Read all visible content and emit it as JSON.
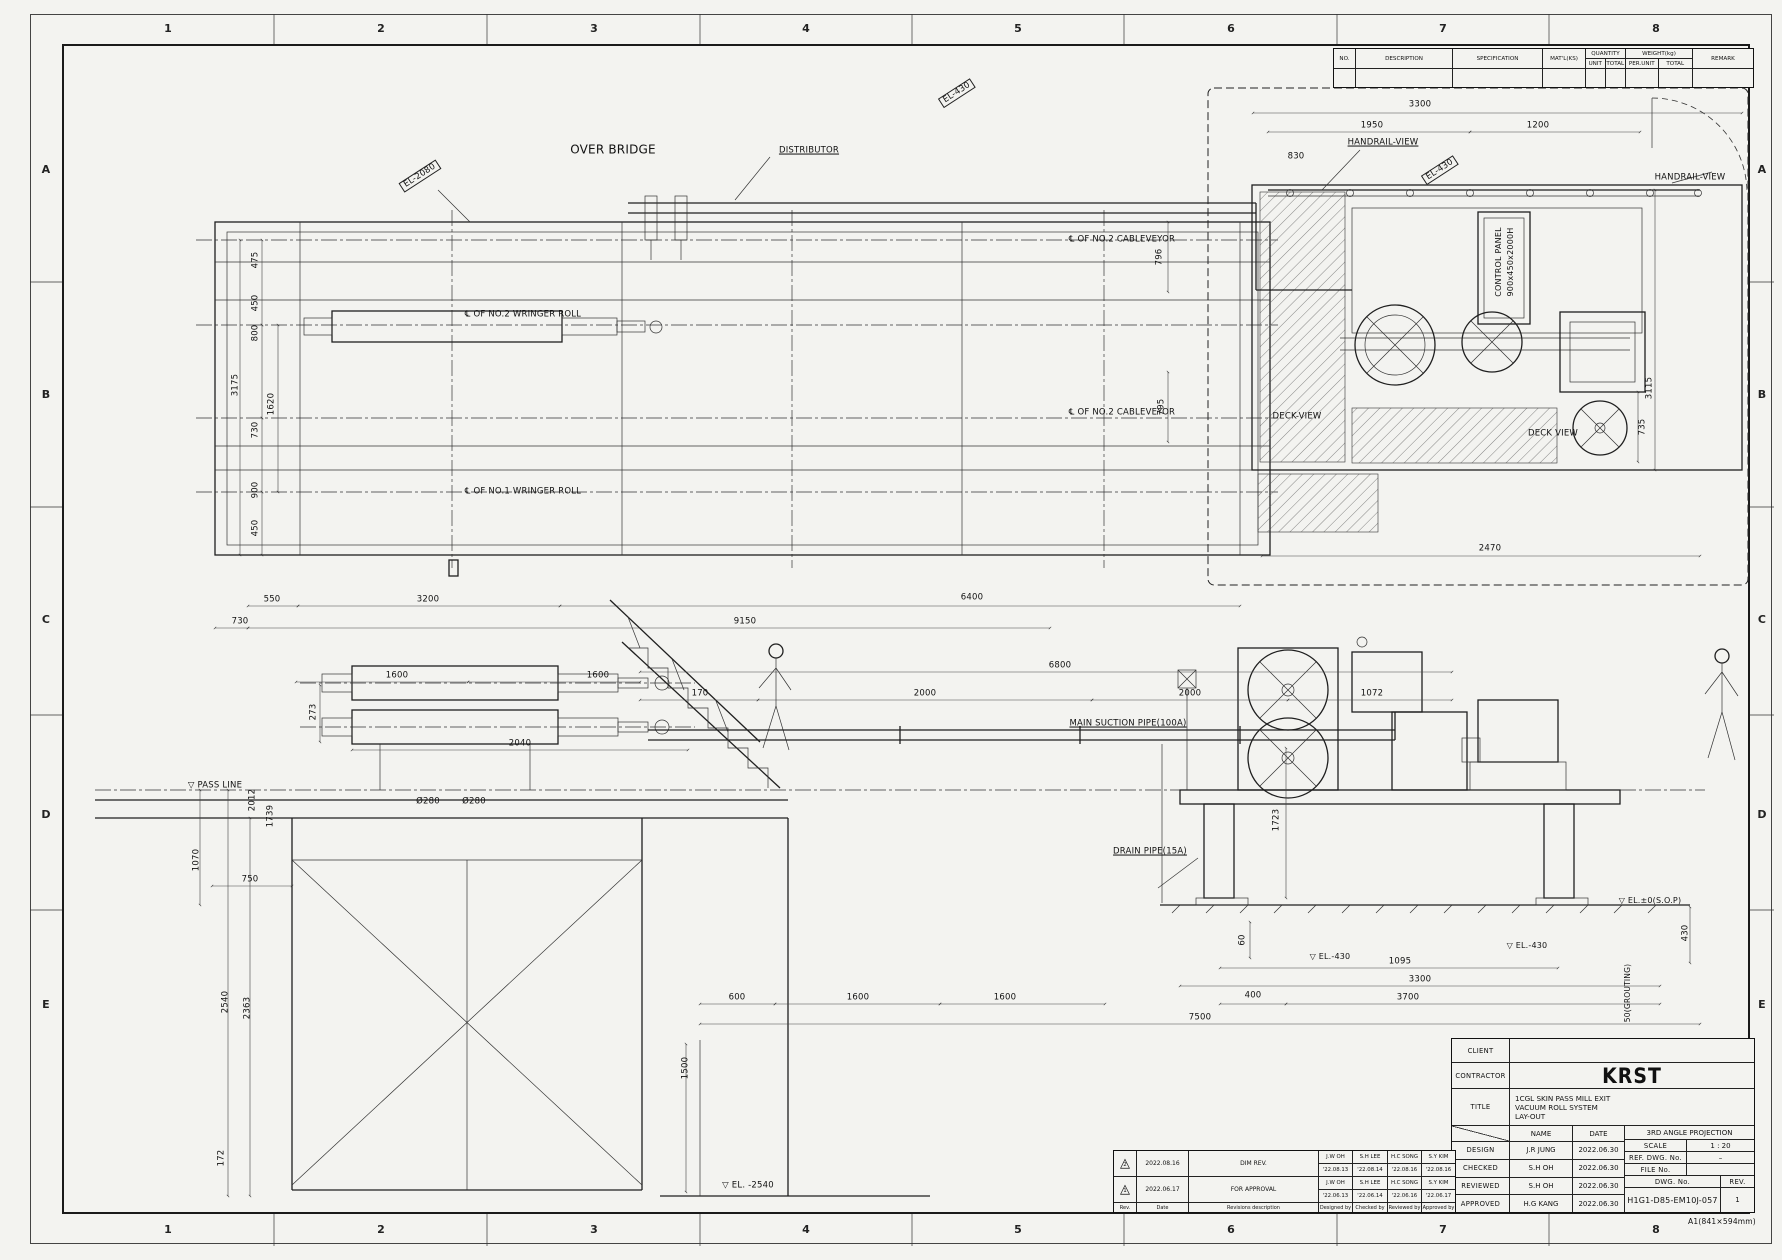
{
  "sheet": {
    "size_note": "A1(841×594mm)",
    "paper_color": "#f3f3f0",
    "line_color": "#1f1f1f"
  },
  "parts_table": {
    "no_label": "NO.",
    "description_label": "DESCRIPTION",
    "specification_label": "SPECIFICATION",
    "matl_label": "MAT'L(KS)",
    "quantity_label": "QUANTITY",
    "unit_label": "UNIT",
    "total_label": "TOTAL",
    "weight_label": "WEIGHT(kg)",
    "per_unit_label": "PER.UNIT",
    "remark_label": "REMARK"
  },
  "title_block": {
    "client_label": "CLIENT",
    "contractor_label": "CONTRACTOR",
    "contractor_name": "KRST",
    "title_label": "TITLE",
    "title_lines": [
      "1CGL SKIN PASS MILL EXIT",
      "VACUUM ROLL SYSTEM",
      "LAY-OUT"
    ],
    "name_label": "NAME",
    "date_label": "DATE",
    "rows": [
      {
        "label": "DESIGN",
        "name": "J.R JUNG",
        "date": "2022.06.30"
      },
      {
        "label": "CHECKED",
        "name": "S.H OH",
        "date": "2022.06.30"
      },
      {
        "label": "REVIEWED",
        "name": "S.H OH",
        "date": "2022.06.30"
      },
      {
        "label": "APPROVED",
        "name": "H.G KANG",
        "date": "2022.06.30"
      }
    ],
    "projection": "3RD ANGLE PROJECTION",
    "scale_label": "SCALE",
    "scale": "1 : 20",
    "ref_label": "REF. DWG. No.",
    "ref": "–",
    "file_label": "FILE No.",
    "file": "",
    "dwg_label": "DWG. No.",
    "dwg_no": "H1G1-D85-EM10J-057",
    "rev_label": "REV.",
    "rev": "1"
  },
  "revision_table": {
    "rows": [
      {
        "sym": "2",
        "date": "2022.08.16",
        "desc": "DIM REV.",
        "d_name": "J.W OH",
        "d_date": "'22.08.13",
        "c_name": "S.H LEE",
        "c_date": "'22.08.14",
        "r_name": "H.C SONG",
        "r_date": "'22.08.16",
        "a_name": "S.Y KIM",
        "a_date": "'22.08.16"
      },
      {
        "sym": "1",
        "date": "2022.06.17",
        "desc": "FOR APPROVAL",
        "d_name": "J.W OH",
        "d_date": "'22.06.13",
        "c_name": "S.H LEE",
        "c_date": "'22.06.14",
        "r_name": "H.C SONG",
        "r_date": "'22.06.16",
        "a_name": "S.Y KIM",
        "a_date": "'22.06.17"
      }
    ],
    "footer": [
      "Rev.",
      "Date",
      "Revisions description",
      "Designed by",
      "Checked by",
      "Reviewed by",
      "Approved by"
    ]
  },
  "annotations": [
    {
      "t": "1",
      "x": 168,
      "y": 29,
      "c": "grid",
      "n": "grid-col-1-top"
    },
    {
      "t": "2",
      "x": 381,
      "y": 29,
      "c": "grid",
      "n": "grid-col-2-top"
    },
    {
      "t": "3",
      "x": 594,
      "y": 29,
      "c": "grid",
      "n": "grid-col-3-top"
    },
    {
      "t": "4",
      "x": 806,
      "y": 29,
      "c": "grid",
      "n": "grid-col-4-top"
    },
    {
      "t": "5",
      "x": 1018,
      "y": 29,
      "c": "grid",
      "n": "grid-col-5-top"
    },
    {
      "t": "6",
      "x": 1231,
      "y": 29,
      "c": "grid",
      "n": "grid-col-6-top"
    },
    {
      "t": "7",
      "x": 1443,
      "y": 29,
      "c": "grid",
      "n": "grid-col-7-top"
    },
    {
      "t": "8",
      "x": 1656,
      "y": 29,
      "c": "grid",
      "n": "grid-col-8-top"
    },
    {
      "t": "1",
      "x": 168,
      "y": 1230,
      "c": "grid",
      "n": "grid-col-1-bottom"
    },
    {
      "t": "2",
      "x": 381,
      "y": 1230,
      "c": "grid",
      "n": "grid-col-2-bottom"
    },
    {
      "t": "3",
      "x": 594,
      "y": 1230,
      "c": "grid",
      "n": "grid-col-3-bottom"
    },
    {
      "t": "4",
      "x": 806,
      "y": 1230,
      "c": "grid",
      "n": "grid-col-4-bottom"
    },
    {
      "t": "5",
      "x": 1018,
      "y": 1230,
      "c": "grid",
      "n": "grid-col-5-bottom"
    },
    {
      "t": "6",
      "x": 1231,
      "y": 1230,
      "c": "grid",
      "n": "grid-col-6-bottom"
    },
    {
      "t": "7",
      "x": 1443,
      "y": 1230,
      "c": "grid",
      "n": "grid-col-7-bottom"
    },
    {
      "t": "8",
      "x": 1656,
      "y": 1230,
      "c": "grid",
      "n": "grid-col-8-bottom"
    },
    {
      "t": "A",
      "x": 46,
      "y": 170,
      "c": "grid",
      "n": "grid-row-a-left"
    },
    {
      "t": "B",
      "x": 46,
      "y": 395,
      "c": "grid",
      "n": "grid-row-b-left"
    },
    {
      "t": "C",
      "x": 46,
      "y": 620,
      "c": "grid",
      "n": "grid-row-c-left"
    },
    {
      "t": "D",
      "x": 46,
      "y": 815,
      "c": "grid",
      "n": "grid-row-d-left"
    },
    {
      "t": "E",
      "x": 46,
      "y": 1005,
      "c": "grid",
      "n": "grid-row-e-left"
    },
    {
      "t": "A",
      "x": 1762,
      "y": 170,
      "c": "grid",
      "n": "grid-row-a-right"
    },
    {
      "t": "B",
      "x": 1762,
      "y": 395,
      "c": "grid",
      "n": "grid-row-b-right"
    },
    {
      "t": "C",
      "x": 1762,
      "y": 620,
      "c": "grid",
      "n": "grid-row-c-right"
    },
    {
      "t": "D",
      "x": 1762,
      "y": 815,
      "c": "grid",
      "n": "grid-row-d-right"
    },
    {
      "t": "E",
      "x": 1762,
      "y": 1005,
      "c": "grid",
      "n": "grid-row-e-right"
    },
    {
      "t": "OVER BRIDGE",
      "x": 613,
      "y": 150,
      "s": 12,
      "n": "label-over-bridge"
    },
    {
      "t": "DISTRIBUTOR",
      "x": 809,
      "y": 151,
      "c": "u",
      "n": "label-distributor"
    },
    {
      "t": "EL-2080",
      "x": 420,
      "y": 176,
      "r": -33,
      "c": "box",
      "n": "tag-el-2080"
    },
    {
      "t": "EL-430",
      "x": 957,
      "y": 93,
      "r": -33,
      "c": "box",
      "n": "tag-el-430-pipe"
    },
    {
      "t": "EL-430",
      "x": 1440,
      "y": 170,
      "r": -33,
      "c": "box",
      "n": "tag-el-430-deck"
    },
    {
      "t": "℄ OF NO.2 CABLEVEYOR",
      "x": 1122,
      "y": 240,
      "n": "label-cl-no2-cableveyor-upper"
    },
    {
      "t": "℄ OF NO.2 WRINGER ROLL",
      "x": 523,
      "y": 315,
      "n": "label-cl-no2-wringer-roll"
    },
    {
      "t": "℄ OF NO.2 CABLEVEYOR",
      "x": 1122,
      "y": 413,
      "n": "label-cl-no2-cableveyor-lower"
    },
    {
      "t": "℄ OF NO.1 WRINGER ROLL",
      "x": 523,
      "y": 492,
      "n": "label-cl-no1-wringer-roll"
    },
    {
      "t": "HANDRAIL-VIEW",
      "x": 1383,
      "y": 143,
      "c": "u",
      "n": "label-handrail-view-plan"
    },
    {
      "t": "HANDRAIL-VIEW",
      "x": 1690,
      "y": 178,
      "n": "label-handrail-view-right"
    },
    {
      "t": "CONTROL PANEL",
      "x": 1499,
      "y": 262,
      "r": -90,
      "s": 8,
      "n": "label-control-panel"
    },
    {
      "t": "900x450x2000H",
      "x": 1511,
      "y": 262,
      "r": -90,
      "s": 8,
      "n": "label-control-panel-size"
    },
    {
      "t": "DECK-VIEW",
      "x": 1297,
      "y": 417,
      "n": "label-deck-view-left"
    },
    {
      "t": "DECK VIEW",
      "x": 1553,
      "y": 434,
      "n": "label-deck-view-right"
    },
    {
      "t": "MAIN SUCTION PIPE(100A)",
      "x": 1128,
      "y": 724,
      "c": "u",
      "n": "label-main-suction-pipe"
    },
    {
      "t": "DRAIN PIPE(15A)",
      "x": 1150,
      "y": 852,
      "c": "u",
      "n": "label-drain-pipe"
    },
    {
      "t": "▽ PASS LINE",
      "x": 215,
      "y": 786,
      "n": "label-pass-line"
    },
    {
      "t": "▽ EL.-430",
      "x": 1330,
      "y": 957,
      "s": 8,
      "n": "label-el-430-left"
    },
    {
      "t": "▽ EL.-430",
      "x": 1527,
      "y": 946,
      "s": 8,
      "n": "label-el-430-right"
    },
    {
      "t": "▽ EL.±0(S.O.P)",
      "x": 1650,
      "y": 901,
      "s": 8,
      "n": "label-el-0-sop"
    },
    {
      "t": "▽ EL. -2540",
      "x": 748,
      "y": 1186,
      "n": "label-el-2540"
    },
    {
      "t": "50(GROUTING)",
      "x": 1628,
      "y": 993,
      "r": -90,
      "s": 7.5,
      "n": "label-grouting"
    },
    {
      "t": "A1(841×594mm)",
      "x": 1722,
      "y": 1222,
      "s": 7.5,
      "n": "sheet-size-note"
    },
    {
      "t": "3300",
      "x": 1420,
      "y": 105
    },
    {
      "t": "1950",
      "x": 1372,
      "y": 126
    },
    {
      "t": "1200",
      "x": 1538,
      "y": 126
    },
    {
      "t": "830",
      "x": 1296,
      "y": 157
    },
    {
      "t": "2470",
      "x": 1490,
      "y": 549
    },
    {
      "t": "3115",
      "x": 1650,
      "y": 388,
      "r": -90
    },
    {
      "t": "735",
      "x": 1643,
      "y": 427,
      "r": -90
    },
    {
      "t": "796",
      "x": 1160,
      "y": 257,
      "r": -90
    },
    {
      "t": "795",
      "x": 1162,
      "y": 407,
      "r": -90
    },
    {
      "t": "3175",
      "x": 236,
      "y": 385,
      "r": -90
    },
    {
      "t": "475",
      "x": 256,
      "y": 260,
      "r": -90
    },
    {
      "t": "450",
      "x": 256,
      "y": 303,
      "r": -90
    },
    {
      "t": "800",
      "x": 256,
      "y": 333,
      "r": -90
    },
    {
      "t": "1620",
      "x": 272,
      "y": 404,
      "r": -90
    },
    {
      "t": "730",
      "x": 256,
      "y": 430,
      "r": -90
    },
    {
      "t": "900",
      "x": 256,
      "y": 490,
      "r": -90
    },
    {
      "t": "450",
      "x": 256,
      "y": 528,
      "r": -90
    },
    {
      "t": "550",
      "x": 272,
      "y": 600
    },
    {
      "t": "3200",
      "x": 428,
      "y": 600
    },
    {
      "t": "6400",
      "x": 972,
      "y": 598
    },
    {
      "t": "9150",
      "x": 745,
      "y": 622
    },
    {
      "t": "730",
      "x": 240,
      "y": 622
    },
    {
      "t": "6800",
      "x": 1060,
      "y": 666
    },
    {
      "t": "1600",
      "x": 397,
      "y": 676
    },
    {
      "t": "1600",
      "x": 598,
      "y": 676
    },
    {
      "t": "170",
      "x": 700,
      "y": 694
    },
    {
      "t": "2000",
      "x": 925,
      "y": 694
    },
    {
      "t": "2000",
      "x": 1190,
      "y": 694
    },
    {
      "t": "1072",
      "x": 1372,
      "y": 694
    },
    {
      "t": "2040",
      "x": 520,
      "y": 744
    },
    {
      "t": "Ø280",
      "x": 428,
      "y": 802
    },
    {
      "t": "Ø280",
      "x": 474,
      "y": 802
    },
    {
      "t": "273",
      "x": 314,
      "y": 712,
      "r": -90
    },
    {
      "t": "2012",
      "x": 253,
      "y": 800,
      "r": -90
    },
    {
      "t": "1739",
      "x": 271,
      "y": 816,
      "r": -90
    },
    {
      "t": "1070",
      "x": 197,
      "y": 860,
      "r": -90
    },
    {
      "t": "750",
      "x": 250,
      "y": 880
    },
    {
      "t": "1723",
      "x": 1277,
      "y": 820,
      "r": -90
    },
    {
      "t": "60",
      "x": 1243,
      "y": 940,
      "r": -90
    },
    {
      "t": "430",
      "x": 1686,
      "y": 933,
      "r": -90
    },
    {
      "t": "1095",
      "x": 1400,
      "y": 962
    },
    {
      "t": "3300",
      "x": 1420,
      "y": 980
    },
    {
      "t": "400",
      "x": 1253,
      "y": 996
    },
    {
      "t": "3700",
      "x": 1408,
      "y": 998
    },
    {
      "t": "600",
      "x": 737,
      "y": 998
    },
    {
      "t": "1600",
      "x": 858,
      "y": 998
    },
    {
      "t": "1600",
      "x": 1005,
      "y": 998
    },
    {
      "t": "7500",
      "x": 1200,
      "y": 1018
    },
    {
      "t": "1500",
      "x": 686,
      "y": 1068,
      "r": -90
    },
    {
      "t": "2540",
      "x": 226,
      "y": 1002,
      "r": -90
    },
    {
      "t": "2363",
      "x": 248,
      "y": 1008,
      "r": -90
    },
    {
      "t": "172",
      "x": 222,
      "y": 1158,
      "r": -90
    }
  ]
}
